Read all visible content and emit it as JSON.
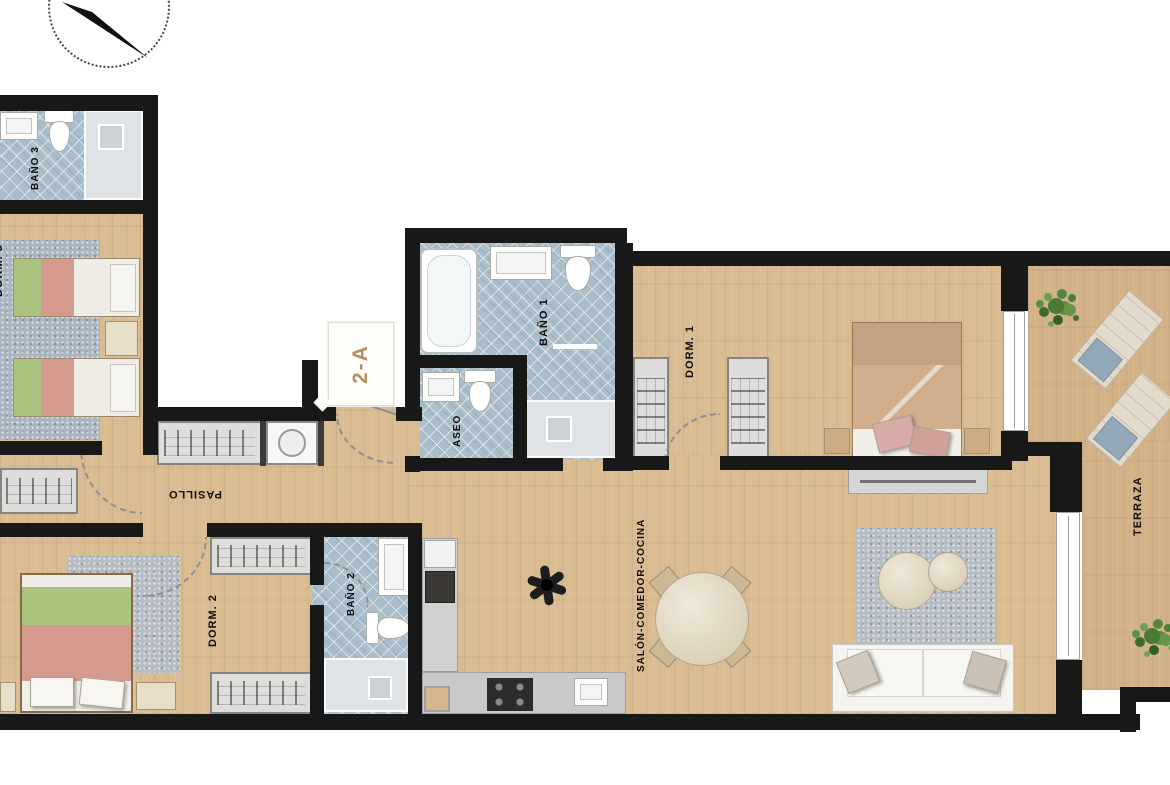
{
  "floor_plan": {
    "unit": {
      "label": "2-A"
    },
    "rooms": {
      "bano3": {
        "label": "BAÑO 3"
      },
      "dorm3": {
        "label": "DORM. 3"
      },
      "pasillo": {
        "label": "PASILLO"
      },
      "aseo": {
        "label": "ASEO"
      },
      "bano1": {
        "label": "BAÑO 1"
      },
      "dorm1": {
        "label": "DORM. 1"
      },
      "dorm2": {
        "label": "DORM. 2"
      },
      "bano2": {
        "label": "BAÑO 2"
      },
      "salon": {
        "label": "SALÓN-COMEDOR-COCINA"
      },
      "terraza": {
        "label": "TERRAZA"
      }
    },
    "icons": [
      "north-compass",
      "single-bed",
      "double-bed",
      "nightstand",
      "wardrobe",
      "washing-machine",
      "bathtub",
      "shower-tray",
      "shower-drain",
      "toilet",
      "sink",
      "kitchen-counter",
      "cooktop",
      "kitchen-sink",
      "oven",
      "fridge",
      "dining-table",
      "dining-chair",
      "sofa",
      "sofa-pillow",
      "coffee-table",
      "rug",
      "ceiling-fan",
      "plant",
      "sun-lounger",
      "sliding-door",
      "window",
      "door-swing-arc"
    ],
    "colors": {
      "wall": "#181818",
      "wood_floor": "#d9bc92",
      "terrace_floor": "#d2b286",
      "bathroom_tile": "#aabdcb",
      "shower_tray": "#e0e3e5",
      "rug_gray": "#b5bcc3",
      "bed_green": "#a9c47f",
      "bed_pink": "#d59a8e",
      "bed_tan": "#d1ae8d",
      "unit_label_text": "#b3905e",
      "plant_green": "#4a7a33",
      "lounger_cushion": "#93a9ba"
    }
  }
}
